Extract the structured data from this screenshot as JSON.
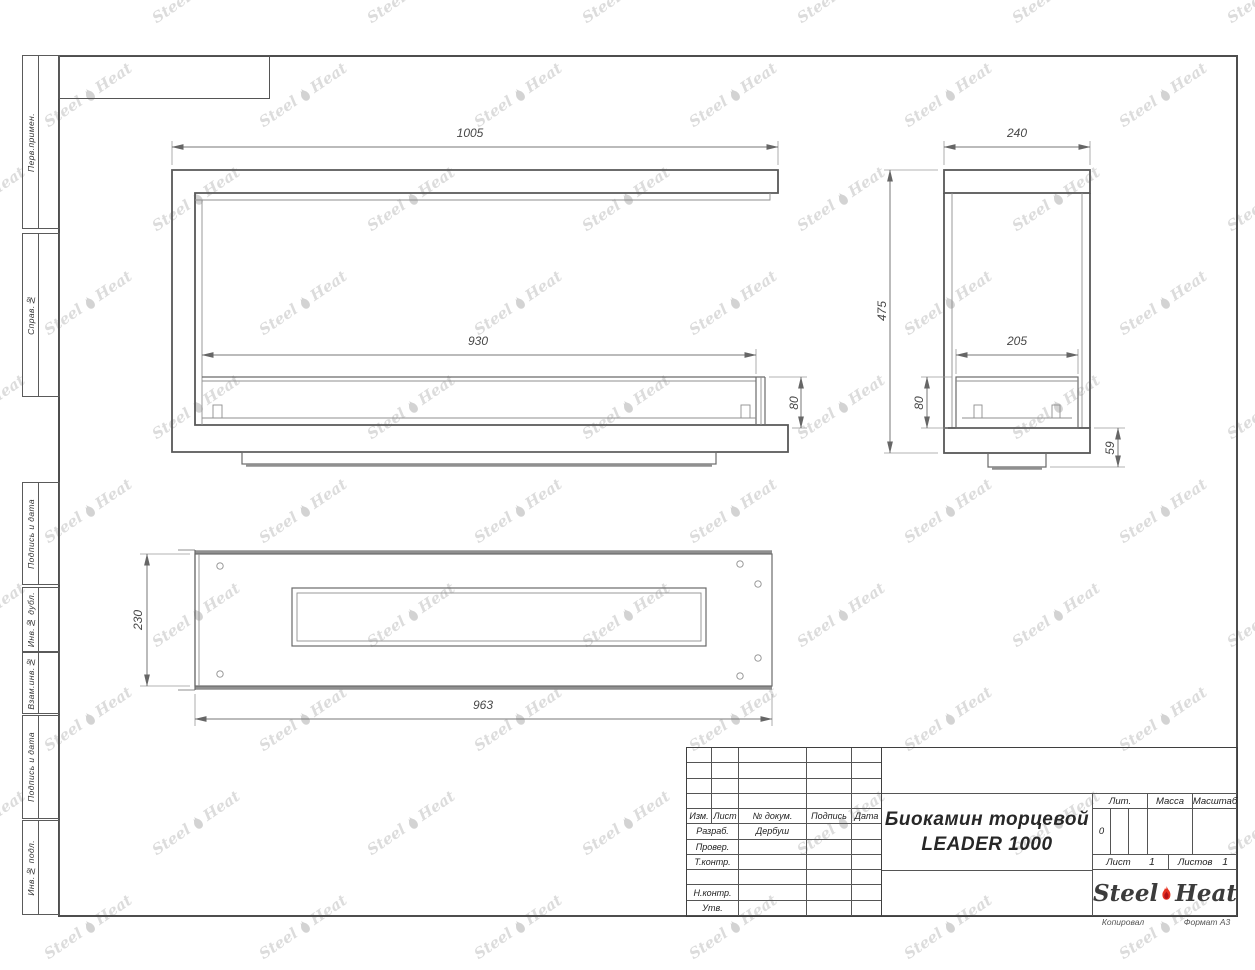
{
  "sheet": {
    "copied_label": "Копировал",
    "format_label": "Формат А3"
  },
  "watermark": {
    "steel": "Steel",
    "heat": "Heat"
  },
  "margin_boxes": [
    {
      "label": "Перв.примен."
    },
    {
      "label": "Справ.№"
    },
    {
      "label": "Подпись и дата"
    },
    {
      "label": "Инв.№ дубл."
    },
    {
      "label": "Взам.инв.№"
    },
    {
      "label": "Подпись и дата"
    },
    {
      "label": "Инв.№ подл."
    }
  ],
  "dimensions": {
    "front": {
      "width": "1005",
      "burner_width": "930",
      "burner_height": "80"
    },
    "side": {
      "depth": "240",
      "height": "475",
      "burner_depth": "205",
      "burner_height": "80",
      "base_height": "59"
    },
    "plan": {
      "depth": "230",
      "length": "963"
    }
  },
  "title_block": {
    "header_cols": [
      "Изм.",
      "Лист",
      "№ докум.",
      "Подпись",
      "Дата"
    ],
    "staff_rows": [
      {
        "label": "Разраб.",
        "value": "Дербуш"
      },
      {
        "label": "Провер.",
        "value": ""
      },
      {
        "label": "Т.контр.",
        "value": ""
      },
      {
        "label": "",
        "value": ""
      },
      {
        "label": "Н.контр.",
        "value": ""
      },
      {
        "label": "Утв.",
        "value": ""
      }
    ],
    "title_line1": "Биокамин торцевой",
    "title_line2": "LEADER 1000",
    "lit_label": "Лит.",
    "lit_value": "0",
    "mass_label": "Масса",
    "scale_label": "Масштаб",
    "sheet_label": "Лист",
    "sheet_value": "1",
    "sheets_label": "Листов",
    "sheets_value": "1",
    "logo": {
      "steel": "Steel",
      "heat": "Heat"
    }
  }
}
